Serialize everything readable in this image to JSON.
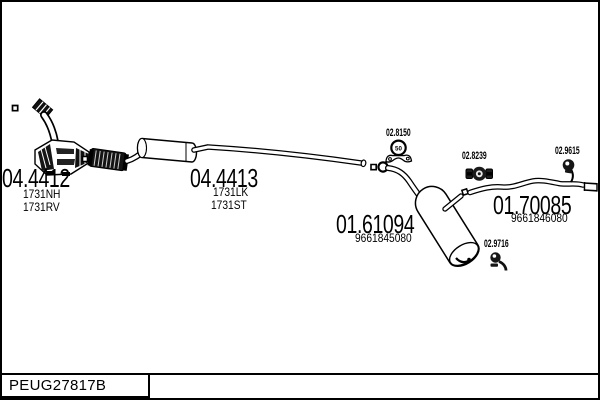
{
  "colors": {
    "ink": "#000000",
    "background": "#ffffff"
  },
  "footer": {
    "catalog_code": "PEUG27817B"
  },
  "parts": {
    "front_pipe": {
      "code": "04.4412",
      "ref1": "1731NH",
      "ref2": "1731RV"
    },
    "center_section": {
      "code": "04.4413",
      "ref1": "1731LK",
      "ref2": "1731ST"
    },
    "rear_muffler": {
      "code": "01.61094",
      "ref1": "9661845080"
    },
    "tail_pipe": {
      "code": "01.70085",
      "ref1": "9661846080"
    },
    "gasket": {
      "code": "02.8150",
      "size_label": "50"
    },
    "clamp": {
      "code": "02.8239"
    },
    "hanger_tail": {
      "code": "02.9615"
    },
    "hanger_rear": {
      "code": "02.9716"
    }
  }
}
